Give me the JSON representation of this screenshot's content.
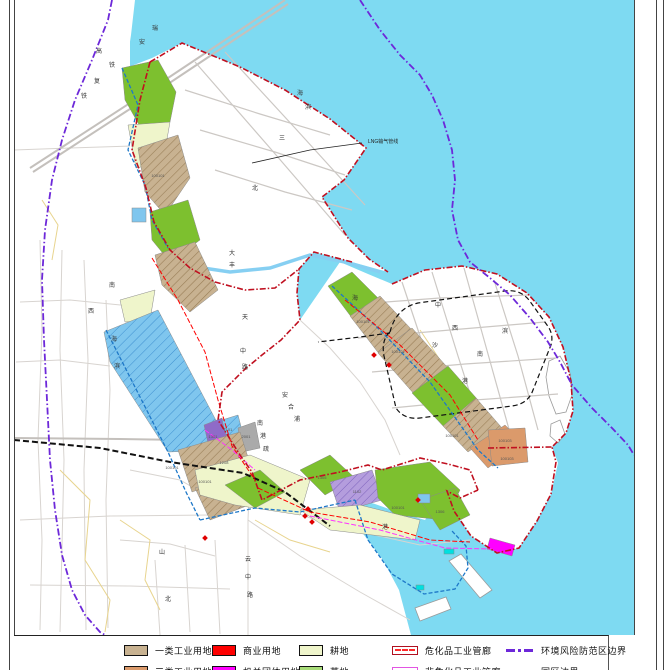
{
  "north": {
    "label": "N"
  },
  "annotations": {
    "lng_pipeline": "LNG输气管线"
  },
  "colors": {
    "sea": "#7EDAF2",
    "land": "#FFFFFF",
    "industrial_class1": "#C8B291",
    "industrial_class3": "#DB9A6B",
    "commercial": "#FE0000",
    "government": "#FF00FF",
    "farmland": "#EFF5CB",
    "grassland_legend": "#A8DC78",
    "grassland_map": "#7DC02F",
    "water_zone": "#7FC6EE",
    "purple_zone": "#B49DDD",
    "park_boundary": "#C01020",
    "env_risk_boundary": "#6D28D9",
    "coast_line": "#1E78C8",
    "hazmat_corridor": "#FF0000",
    "non_hazmat_corridor": "#FF33FF"
  },
  "map_labels": {
    "road_chars": [
      {
        "t": "瑞",
        "x": 155,
        "y": 30
      },
      {
        "t": "安",
        "x": 142,
        "y": 44
      },
      {
        "t": "高",
        "x": 99,
        "y": 53
      },
      {
        "t": "铁",
        "x": 112,
        "y": 67
      },
      {
        "t": "复",
        "x": 97,
        "y": 83
      },
      {
        "t": "铁",
        "x": 84,
        "y": 98
      },
      {
        "t": "南",
        "x": 112,
        "y": 287
      },
      {
        "t": "西",
        "x": 91,
        "y": 313
      },
      {
        "t": "海",
        "x": 114,
        "y": 341
      },
      {
        "t": "滨",
        "x": 117,
        "y": 368
      },
      {
        "t": "大",
        "x": 232,
        "y": 255
      },
      {
        "t": "丰",
        "x": 232,
        "y": 267
      },
      {
        "t": "天",
        "x": 245,
        "y": 319
      },
      {
        "t": "中",
        "x": 243,
        "y": 353
      },
      {
        "t": "路",
        "x": 245,
        "y": 369
      },
      {
        "t": "安",
        "x": 285,
        "y": 397
      },
      {
        "t": "合",
        "x": 291,
        "y": 409
      },
      {
        "t": "浦",
        "x": 297,
        "y": 421
      },
      {
        "t": "南",
        "x": 260,
        "y": 425
      },
      {
        "t": "港",
        "x": 263,
        "y": 438
      },
      {
        "t": "疏",
        "x": 266,
        "y": 451
      },
      {
        "t": "海",
        "x": 355,
        "y": 300
      },
      {
        "t": "中",
        "x": 438,
        "y": 307
      },
      {
        "t": "沙",
        "x": 435,
        "y": 347
      },
      {
        "t": "西",
        "x": 455,
        "y": 330
      },
      {
        "t": "南",
        "x": 480,
        "y": 356
      },
      {
        "t": "港",
        "x": 465,
        "y": 383
      },
      {
        "t": "滨",
        "x": 505,
        "y": 333
      },
      {
        "t": "云",
        "x": 248,
        "y": 561
      },
      {
        "t": "中",
        "x": 248,
        "y": 579
      },
      {
        "t": "路",
        "x": 250,
        "y": 597
      },
      {
        "t": "山",
        "x": 162,
        "y": 554
      },
      {
        "t": "北",
        "x": 168,
        "y": 601
      },
      {
        "t": "港",
        "x": 385,
        "y": 529
      },
      {
        "t": "海",
        "x": 300,
        "y": 95
      },
      {
        "t": "滨",
        "x": 308,
        "y": 109
      },
      {
        "t": "三",
        "x": 282,
        "y": 140
      },
      {
        "t": "北",
        "x": 255,
        "y": 190
      }
    ],
    "parcels": [
      {
        "t": "100101",
        "x": 158,
        "y": 177
      },
      {
        "t": "100101",
        "x": 172,
        "y": 469
      },
      {
        "t": "100101",
        "x": 205,
        "y": 483
      },
      {
        "t": "100101",
        "x": 363,
        "y": 323
      },
      {
        "t": "100101",
        "x": 398,
        "y": 353
      },
      {
        "t": "100101",
        "x": 452,
        "y": 437
      },
      {
        "t": "100101",
        "x": 398,
        "y": 509
      },
      {
        "t": "100103",
        "x": 505,
        "y": 442
      },
      {
        "t": "100103",
        "x": 507,
        "y": 460
      },
      {
        "t": "1102",
        "x": 357,
        "y": 493
      },
      {
        "t": "1301",
        "x": 213,
        "y": 438
      },
      {
        "t": "1101",
        "x": 228,
        "y": 431
      },
      {
        "t": "2001",
        "x": 246,
        "y": 438
      },
      {
        "t": "1208",
        "x": 224,
        "y": 464
      },
      {
        "t": "1305",
        "x": 322,
        "y": 479
      },
      {
        "t": "1306",
        "x": 440,
        "y": 513
      }
    ]
  },
  "legend": {
    "rows": [
      {
        "items": [
          {
            "kind": "swatch",
            "color": "#C8B291",
            "label": "一类工业用地"
          },
          {
            "kind": "swatch",
            "color": "#FE0000",
            "label": "商业用地"
          },
          {
            "kind": "swatch",
            "color": "#EFF5CB",
            "label": "耕地"
          },
          {
            "kind": "linebox",
            "color": "#B01020",
            "dash": "#FF2A2A",
            "label": "危化品工业管廊"
          },
          {
            "kind": "dashdot",
            "color": "#6D28D9",
            "label": "环境风险防范区边界"
          }
        ]
      },
      {
        "items": [
          {
            "kind": "swatch",
            "color": "#DB9A6B",
            "label": "三类工业用地"
          },
          {
            "kind": "swatch",
            "color": "#FF00FF",
            "label": "机关团体用地"
          },
          {
            "kind": "swatch",
            "color": "#A8DC78",
            "label": "草地"
          },
          {
            "kind": "linebox",
            "color": "#E255E2",
            "dash": "#FF33FF",
            "label": "非危化品工业管廊"
          },
          {
            "kind": "dashdot",
            "color": "#CC1111",
            "label": "园区边界"
          }
        ]
      }
    ],
    "col_x": [
      28,
      116,
      203,
      296,
      410
    ]
  }
}
